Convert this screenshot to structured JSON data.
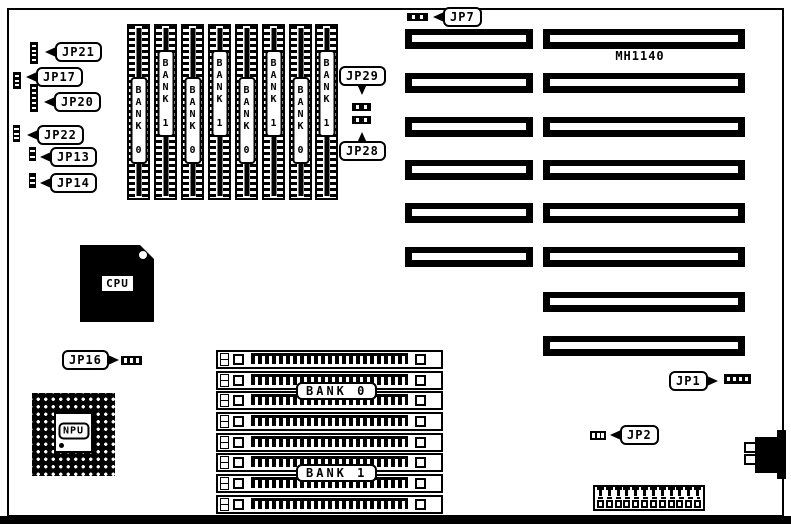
{
  "board": {
    "model": "MH1140"
  },
  "jumpers": {
    "jp21": "JP21",
    "jp17": "JP17",
    "jp20": "JP20",
    "jp22": "JP22",
    "jp13": "JP13",
    "jp14": "JP14",
    "jp7": "JP7",
    "jp29": "JP29",
    "jp28": "JP28",
    "jp16": "JP16",
    "jp1": "JP1",
    "jp2": "JP2"
  },
  "chips": {
    "cpu": "CPU",
    "npu": "NPU"
  },
  "memory": {
    "vertical_banks": [
      "BANK 0",
      "BANK 1",
      "BANK 0",
      "BANK 1",
      "BANK 0",
      "BANK 1",
      "BANK 0",
      "BANK 1"
    ],
    "horizontal_banks": [
      "BANK 0",
      "BANK 1"
    ]
  }
}
